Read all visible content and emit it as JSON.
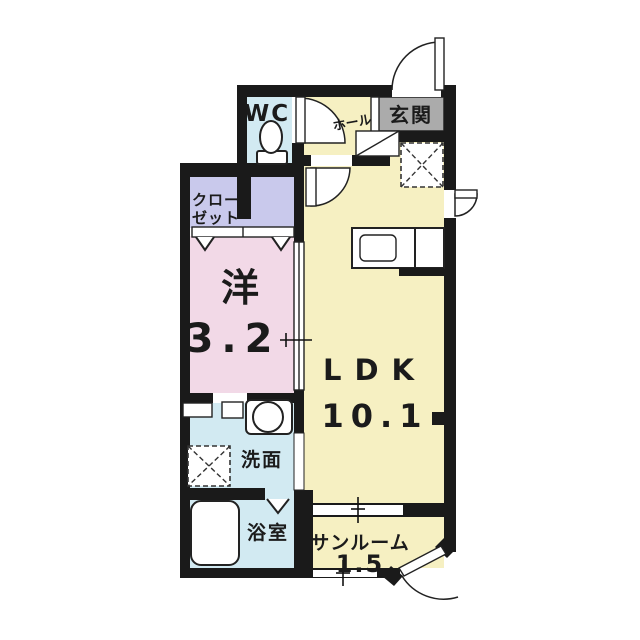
{
  "plan": {
    "kind": "japanese-apartment-floor-plan",
    "rooms": {
      "wc": {
        "label": "WC"
      },
      "hall": {
        "label": "ホール"
      },
      "entrance": {
        "label": "玄関"
      },
      "closet": {
        "label_line1": "クロー",
        "label_line2": "ゼット"
      },
      "western_room": {
        "label": "洋",
        "size": "3.2"
      },
      "ldk": {
        "label": "LDK",
        "size": "10.1"
      },
      "washroom": {
        "label": "洗面"
      },
      "bathroom": {
        "label": "浴室"
      },
      "sunroom": {
        "label": "サンルーム",
        "size": "1.5"
      }
    },
    "colors": {
      "wall": "#1a1a1a",
      "room_yellow": "#f6f0c2",
      "room_pink": "#f2d9e7",
      "room_cyan": "#d2eaf2",
      "room_lavender": "#c9c9ec",
      "entrance_gray": "#ababab",
      "background": "#ffffff"
    }
  }
}
